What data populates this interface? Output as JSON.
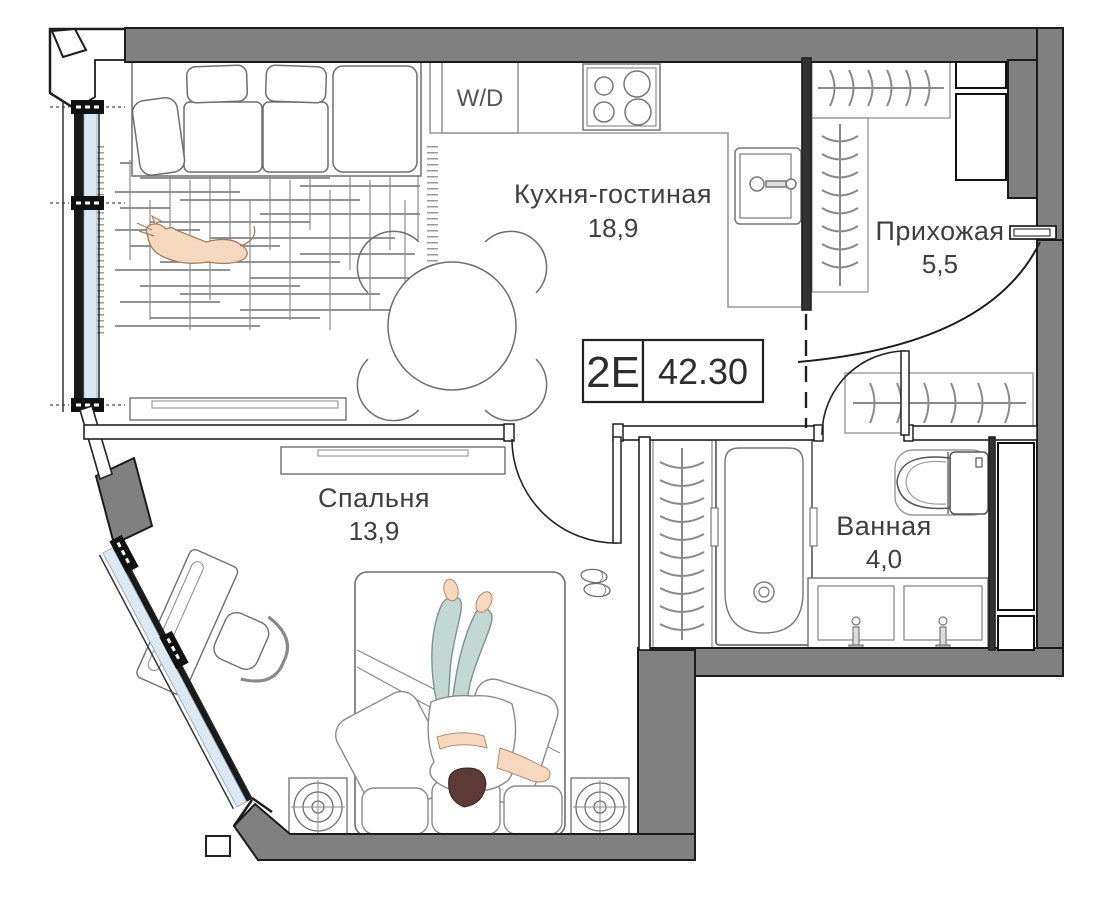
{
  "plan": {
    "badge": {
      "unit_code": "2Е",
      "total_area": "42.30"
    },
    "rooms": [
      {
        "name": "Кухня-гостиная",
        "area": "18,9"
      },
      {
        "name": "Прихожая",
        "area": "5,5"
      },
      {
        "name": "Спальня",
        "area": "13,9"
      },
      {
        "name": "Ванная",
        "area": "4,0"
      }
    ],
    "appliances": {
      "washer_dryer_label": "W/D"
    },
    "colors": {
      "wall": "#808080",
      "glass": "#dce8f2",
      "outline": "#1c1c1c",
      "furniture_line": "#6e6e6e",
      "skin": "#f6d8be",
      "hair": "#5d3a35",
      "clothing": "#c3d8d2",
      "label_text": "#3f3f3f"
    }
  }
}
